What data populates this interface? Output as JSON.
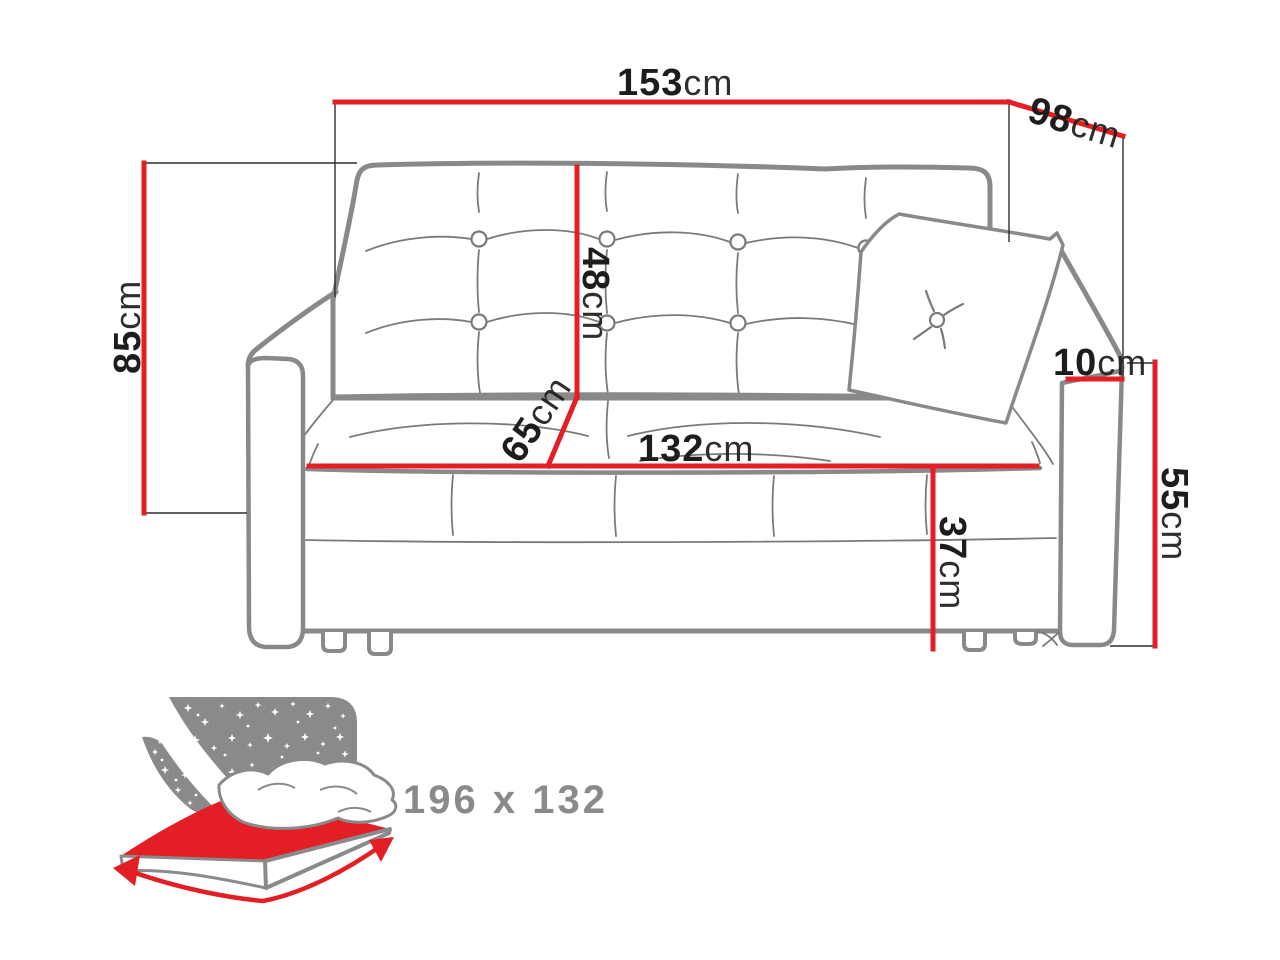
{
  "diagram": {
    "type": "sofa-bed-dimension-drawing",
    "unit_default": "cm",
    "dims": {
      "overall_width": {
        "value": "153",
        "unit": "cm"
      },
      "overall_depth": {
        "value": "98",
        "unit": "cm"
      },
      "overall_height": {
        "value": "85",
        "unit": "cm"
      },
      "backrest_height": {
        "value": "48",
        "unit": "cm"
      },
      "seat_depth": {
        "value": "65",
        "unit": "cm"
      },
      "seat_width": {
        "value": "132",
        "unit": "cm"
      },
      "seat_height": {
        "value": "37",
        "unit": "cm"
      },
      "armrest_width": {
        "value": "10",
        "unit": "cm"
      },
      "armrest_height": {
        "value": "55",
        "unit": "cm"
      }
    },
    "sleep_function": {
      "dimensions_label": "196 x 132",
      "icon": "bed-with-starry-headboard-icon"
    },
    "colors": {
      "dimension_red": "#e31e24",
      "outline_gray": "#898989",
      "seam_gray": "#7a7a7a",
      "label_black": "#1d1d1b",
      "sleep_gray": "#8a8a8a",
      "background": "#ffffff"
    }
  }
}
